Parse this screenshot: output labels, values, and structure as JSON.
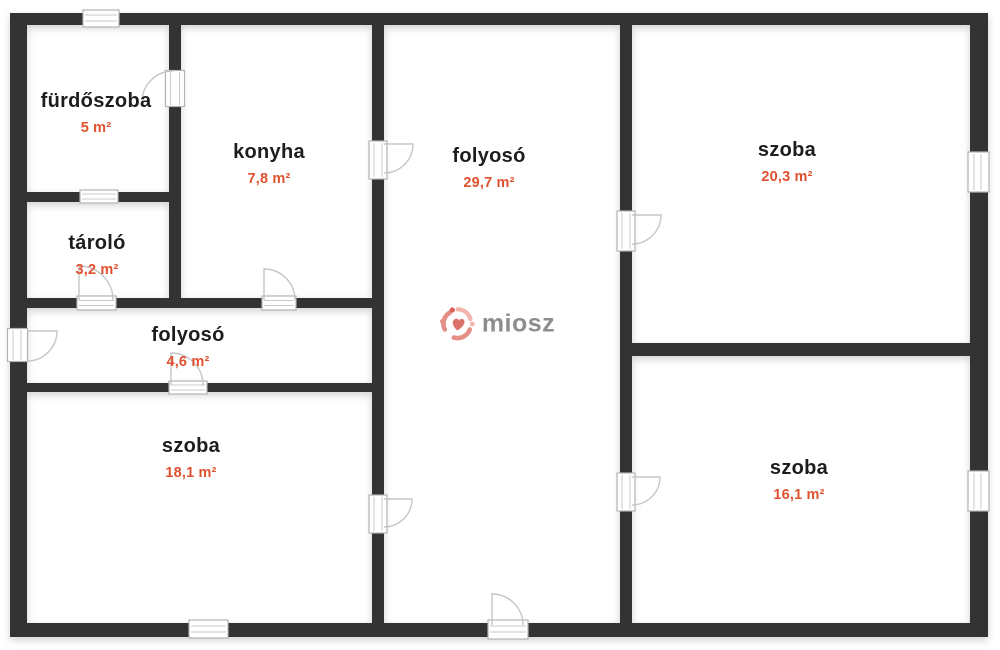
{
  "rooms": [
    {
      "name": "fürdőszoba",
      "area": "5 m²"
    },
    {
      "name": "konyha",
      "area": "7,8 m²"
    },
    {
      "name": "tároló",
      "area": "3,2 m²"
    },
    {
      "name": "folyosó",
      "area": "4,6 m²"
    },
    {
      "name": "folyosó",
      "area": "29,7 m²"
    },
    {
      "name": "szoba",
      "area": "20,3 m²"
    },
    {
      "name": "szoba",
      "area": "18,1 m²"
    },
    {
      "name": "szoba",
      "area": "16,1 m²"
    }
  ],
  "watermark": {
    "text": "miosz"
  },
  "colors": {
    "wall": "#333333",
    "room_name": "#1d1d1d",
    "room_area": "#e0512f",
    "watermark_text": "#8d8d8d",
    "watermark_icon": "#e58e85",
    "watermark_icon_accent": "#d95f57"
  }
}
